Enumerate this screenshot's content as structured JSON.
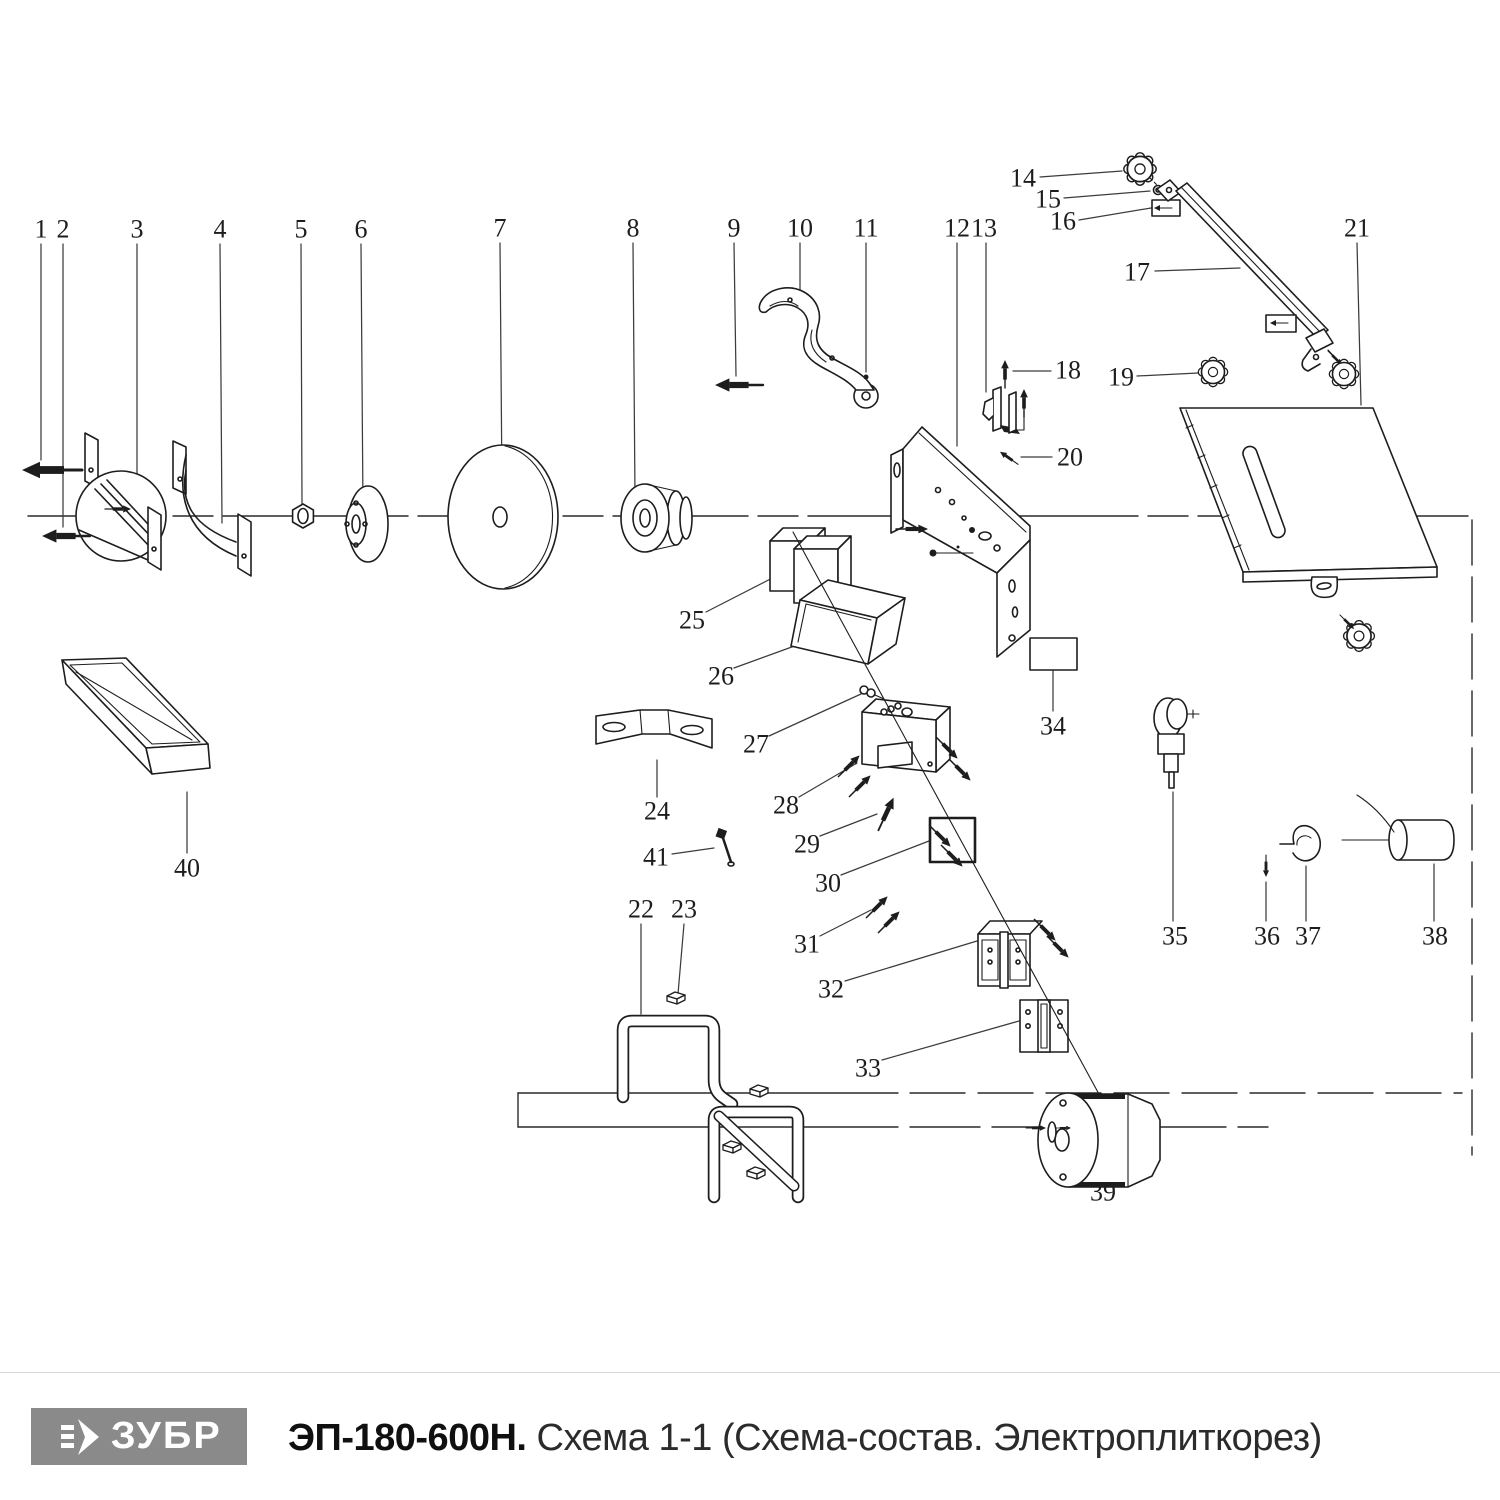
{
  "footer": {
    "brand": "ЗУБР",
    "model": "ЭП-180-600Н.",
    "subtitle": "Схема 1-1 (Схема-состав. Электроплиткорез)"
  },
  "colors": {
    "line": "#1d1d1d",
    "leader": "#3c3c3c",
    "logo_bg": "#8a8a8a",
    "logo_text": "#ffffff",
    "separator": "#d8d8d8",
    "label_text": "#1d1d1d"
  },
  "diagram": {
    "kind": "exploded-parts-schematic",
    "parts": [
      {
        "num": "1",
        "x": 41,
        "y": 229
      },
      {
        "num": "2",
        "x": 63,
        "y": 229
      },
      {
        "num": "3",
        "x": 137,
        "y": 229
      },
      {
        "num": "4",
        "x": 220,
        "y": 229
      },
      {
        "num": "5",
        "x": 301,
        "y": 229
      },
      {
        "num": "6",
        "x": 361,
        "y": 229
      },
      {
        "num": "7",
        "x": 500,
        "y": 228
      },
      {
        "num": "8",
        "x": 633,
        "y": 228
      },
      {
        "num": "9",
        "x": 734,
        "y": 228
      },
      {
        "num": "10",
        "x": 800,
        "y": 228
      },
      {
        "num": "11",
        "x": 866,
        "y": 228
      },
      {
        "num": "12",
        "x": 957,
        "y": 228
      },
      {
        "num": "13",
        "x": 984,
        "y": 228
      },
      {
        "num": "14",
        "x": 1023,
        "y": 178
      },
      {
        "num": "15",
        "x": 1048,
        "y": 199
      },
      {
        "num": "16",
        "x": 1063,
        "y": 221
      },
      {
        "num": "17",
        "x": 1137,
        "y": 272
      },
      {
        "num": "18",
        "x": 1068,
        "y": 370
      },
      {
        "num": "19",
        "x": 1121,
        "y": 377
      },
      {
        "num": "20",
        "x": 1070,
        "y": 457
      },
      {
        "num": "21",
        "x": 1357,
        "y": 228
      },
      {
        "num": "22",
        "x": 641,
        "y": 909
      },
      {
        "num": "23",
        "x": 684,
        "y": 909
      },
      {
        "num": "24",
        "x": 657,
        "y": 811
      },
      {
        "num": "25",
        "x": 692,
        "y": 620
      },
      {
        "num": "26",
        "x": 721,
        "y": 676
      },
      {
        "num": "27",
        "x": 756,
        "y": 744
      },
      {
        "num": "28",
        "x": 786,
        "y": 805
      },
      {
        "num": "29",
        "x": 807,
        "y": 844
      },
      {
        "num": "30",
        "x": 828,
        "y": 883
      },
      {
        "num": "31",
        "x": 807,
        "y": 944
      },
      {
        "num": "32",
        "x": 831,
        "y": 989
      },
      {
        "num": "33",
        "x": 868,
        "y": 1068
      },
      {
        "num": "34",
        "x": 1053,
        "y": 726
      },
      {
        "num": "35",
        "x": 1175,
        "y": 936
      },
      {
        "num": "36",
        "x": 1267,
        "y": 936
      },
      {
        "num": "37",
        "x": 1308,
        "y": 936
      },
      {
        "num": "38",
        "x": 1435,
        "y": 936
      },
      {
        "num": "39",
        "x": 1103,
        "y": 1192
      },
      {
        "num": "40",
        "x": 187,
        "y": 868
      },
      {
        "num": "41",
        "x": 656,
        "y": 857
      }
    ]
  }
}
